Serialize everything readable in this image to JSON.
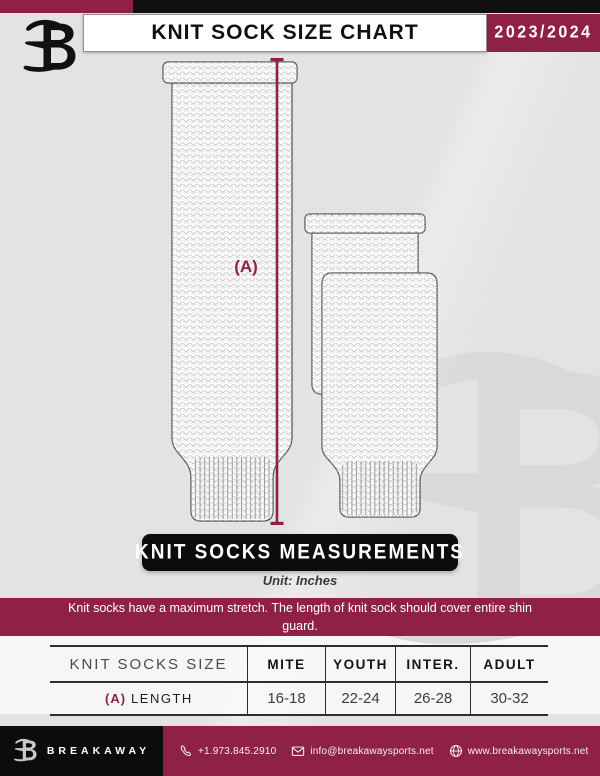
{
  "header": {
    "title": "KNIT SOCK SIZE CHART",
    "season": "2023/2024"
  },
  "figure": {
    "dimension_label": "(A)",
    "measurements_banner": "KNIT SOCKS MEASUREMENTS",
    "unit_label": "Unit: Inches",
    "note": "Knit socks have a maximum stretch. The length of knit sock should cover entire shin guard."
  },
  "size_table": {
    "header": [
      "KNIT SOCKS SIZE",
      "MITE",
      "YOUTH",
      "INTER.",
      "ADULT"
    ],
    "rows": [
      {
        "dimension": "(A)",
        "label": "LENGTH",
        "values": [
          "16-18",
          "22-24",
          "26-28",
          "30-32"
        ]
      }
    ]
  },
  "footer": {
    "brand_name": "BREAKAWAY",
    "phone": "+1.973.845.2910",
    "email": "info@breakawaysports.net",
    "website": "www.breakawaysports.net"
  },
  "colors": {
    "maroon": "#8e2144",
    "black": "#0c0c0c",
    "background": "#e3e3e2",
    "watermark_gray": "#d9d9d8"
  }
}
